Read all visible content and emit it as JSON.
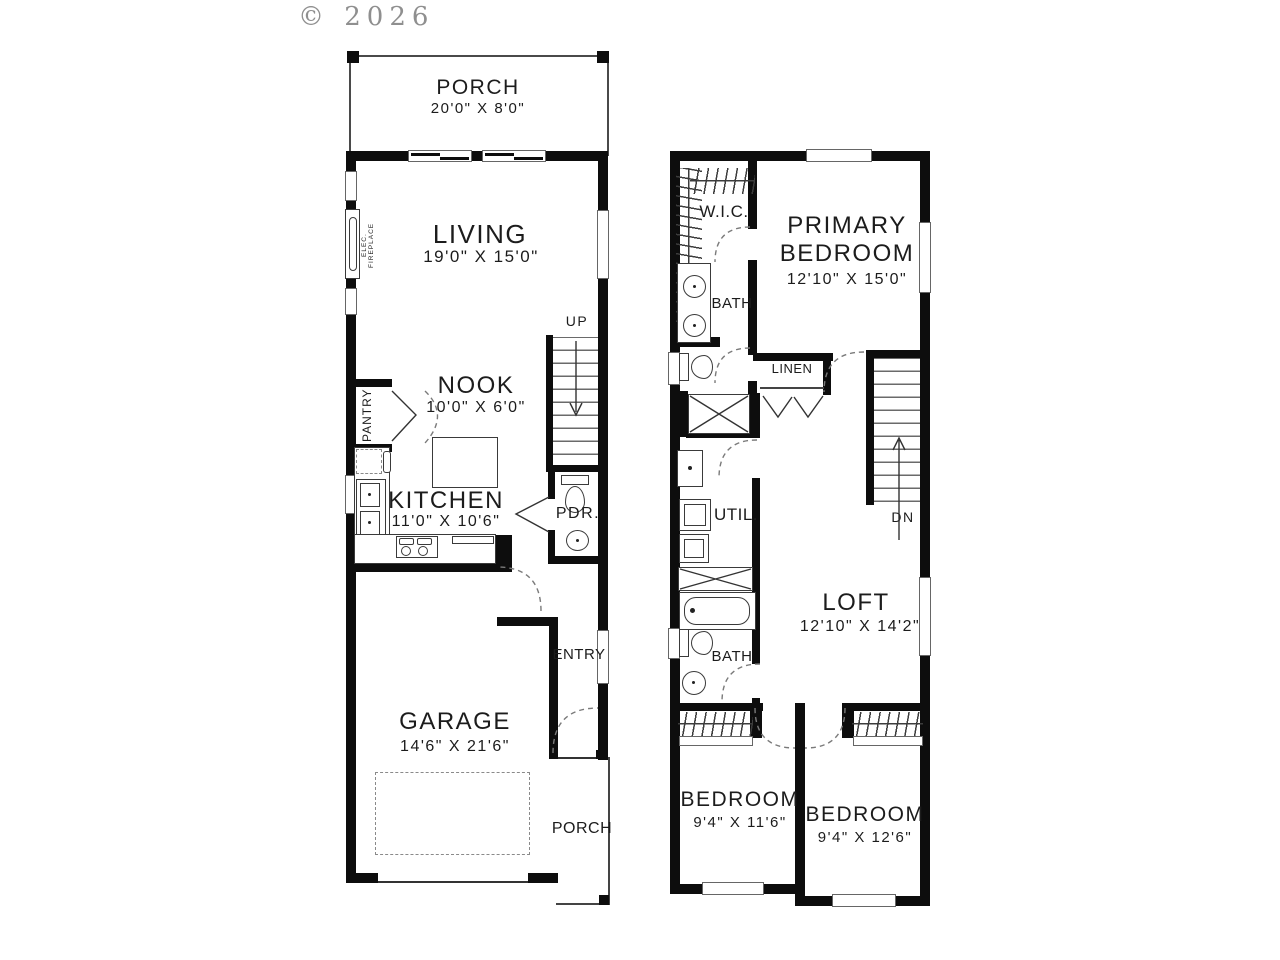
{
  "copyright": "© 2026",
  "wall_color": "#0d0d0d",
  "floor1": {
    "porch_label": "PORCH",
    "porch_dims": "20'0\" X 8'0\"",
    "living_label": "LIVING",
    "living_dims": "19'0\" X 15'0\"",
    "fireplace_label": "ELEC. FIREPLACE",
    "nook_label": "NOOK",
    "nook_dims": "10'0\" X 6'0\"",
    "pantry_label": "PANTRY",
    "kitchen_label": "KITCHEN",
    "kitchen_dims": "11'0\" X 10'6\"",
    "up_label": "UP",
    "pdr_label": "PDR.",
    "entry_label": "ENTRY",
    "garage_label": "GARAGE",
    "garage_dims": "14'6\" X 21'6\"",
    "rear_porch_label": "PORCH"
  },
  "floor2": {
    "wic_label": "W.I.C.",
    "primary_label": "PRIMARY BEDROOM",
    "primary_dims": "12'10\" X 15'0\"",
    "bath1_label": "BATH",
    "linen_label": "LINEN",
    "util_label": "UTIL.",
    "dn_label": "DN",
    "loft_label": "LOFT",
    "loft_dims": "12'10\" X 14'2\"",
    "bath2_label": "BATH",
    "bedroom1_label": "BEDROOM",
    "bedroom1_dims": "9'4\" X 11'6\"",
    "bedroom2_label": "BEDROOM",
    "bedroom2_dims": "9'4\" X 12'6\""
  }
}
